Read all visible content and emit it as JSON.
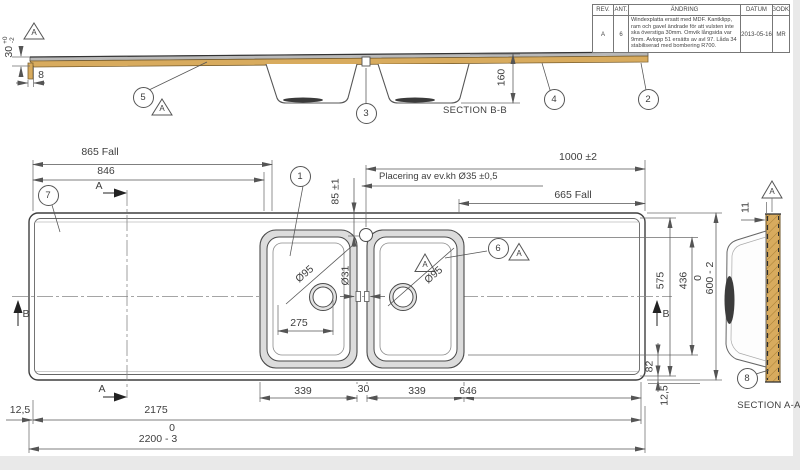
{
  "revision_table": {
    "headers": {
      "rev": "REV.",
      "ant": "ANT.",
      "andring": "ÄNDRING",
      "datum": "DATUM",
      "godk": "GODK."
    },
    "row": {
      "rev": "A",
      "ant": "6",
      "andring": "Windexplatta ersatt med MDF. Kantklipp, ram och gavel ändrade för att vulsten inte ska överstiga 30mm. Omvik långsida var 9mm. Avlopp 51 ersätts av avl 97. Låda 34 stabiliserad med bombering R700.",
      "datum": "2013-05-16",
      "godk": "MR"
    }
  },
  "sections": {
    "bb_label": "SECTION B-B",
    "aa_label": "SECTION A-A"
  },
  "datum": {
    "label": "A"
  },
  "cut_arrows": {
    "a": "A",
    "b": "B"
  },
  "balloons": {
    "b1": "1",
    "b2": "2",
    "b3": "3",
    "b4": "4",
    "b5": "5",
    "b6": "6",
    "b7": "7",
    "b8": "8"
  },
  "dims": {
    "thickness": "30",
    "thickness_tol_plus": "+0",
    "thickness_tol_minus": "-2",
    "lip": "8",
    "bowl_depth": "160",
    "fall_left": "865 Fall",
    "d846": "846",
    "d1000": "1000 ±2",
    "tap_note": "Placering av ev.kh  Ø35 ±0,5",
    "fall_right": "665 Fall",
    "d85": "85 ±1",
    "drain_dia": "Ø95",
    "overflow_dia": "Ø31",
    "d275": "275",
    "d339": "339",
    "d30": "30",
    "d646": "646",
    "d2175": "2175",
    "tol_zero": "0",
    "d2200": "2200 - 3",
    "d125": "12,5",
    "d575": "575",
    "d436": "436",
    "d600": "600 - 2",
    "d82": "82",
    "d11": "11"
  },
  "colors": {
    "wood": "#d8ab5e",
    "steel": "#b9b9b9",
    "line": "#4a4a4a",
    "page_margin": "#e9e9e9"
  }
}
